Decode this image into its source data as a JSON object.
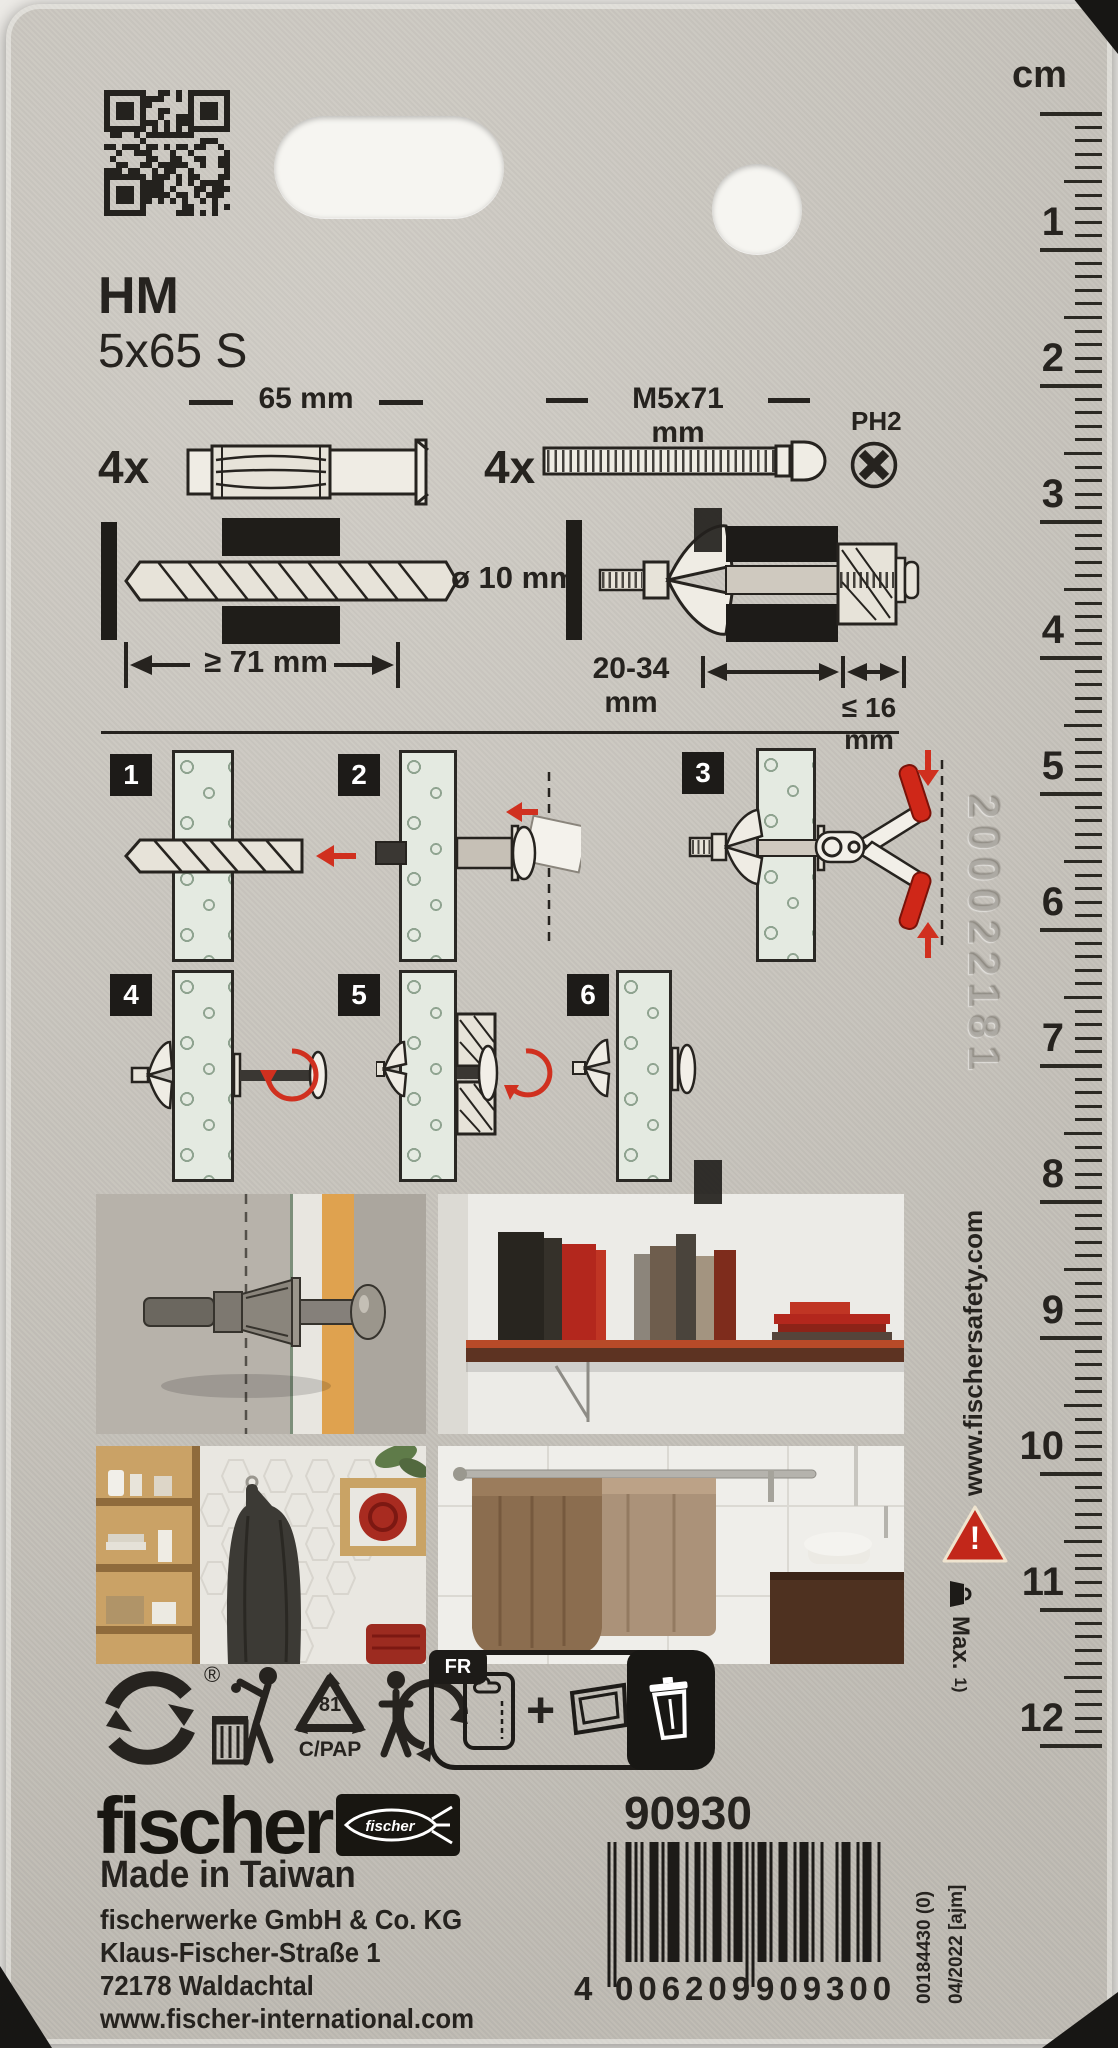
{
  "header": {
    "product_line": "HM",
    "product_size": "5x65 S"
  },
  "components": {
    "anchor_qty": "4x",
    "anchor_length_label": "65 mm",
    "screw_qty": "4x",
    "screw_size_label": "M5x71 mm",
    "screw_drive_label": "PH2"
  },
  "specs": {
    "drill_diameter": "ø 10 mm",
    "min_drill_depth": "≥ 71 mm",
    "grip_range": "20-34 mm",
    "max_fixture": "≤ 16 mm"
  },
  "steps": [
    {
      "num": "1"
    },
    {
      "num": "2"
    },
    {
      "num": "3"
    },
    {
      "num": "4"
    },
    {
      "num": "5"
    },
    {
      "num": "6"
    }
  ],
  "ruler": {
    "unit_label": "cm",
    "numbers": [
      "1",
      "2",
      "3",
      "4",
      "5",
      "6",
      "7",
      "8",
      "9",
      "10",
      "11",
      "12"
    ]
  },
  "side": {
    "safety_url": "www.fischersafety.com",
    "warning_mark": "!",
    "max_load_label": "Max.",
    "footnote": "1)",
    "embossed_code": "200022181",
    "production_code": "00184430 (0)",
    "production_date": "04/2022 [ajm]"
  },
  "recycling": {
    "green_dot_reg": "®",
    "mobius_code": "81",
    "material_code": "C/PAP",
    "fr_label": "FR",
    "plus_sign": "+"
  },
  "footer": {
    "brand": "fischer",
    "fish_logo_text": "fischer",
    "article_number": "90930",
    "origin": "Made in Taiwan",
    "company": "fischerwerke GmbH & Co. KG",
    "street": "Klaus-Fischer-Straße 1",
    "city": "72178 Waldachtal",
    "website": "www.fischer-international.com"
  },
  "barcode": {
    "ean": "4006209909300",
    "display_first": "4",
    "display_left": "006209",
    "display_right": "909300"
  },
  "colors": {
    "accent_red": "#d0301f",
    "card_background": "#c8c4bc",
    "ink": "#26231f",
    "wall_green": "#e4eae1"
  }
}
